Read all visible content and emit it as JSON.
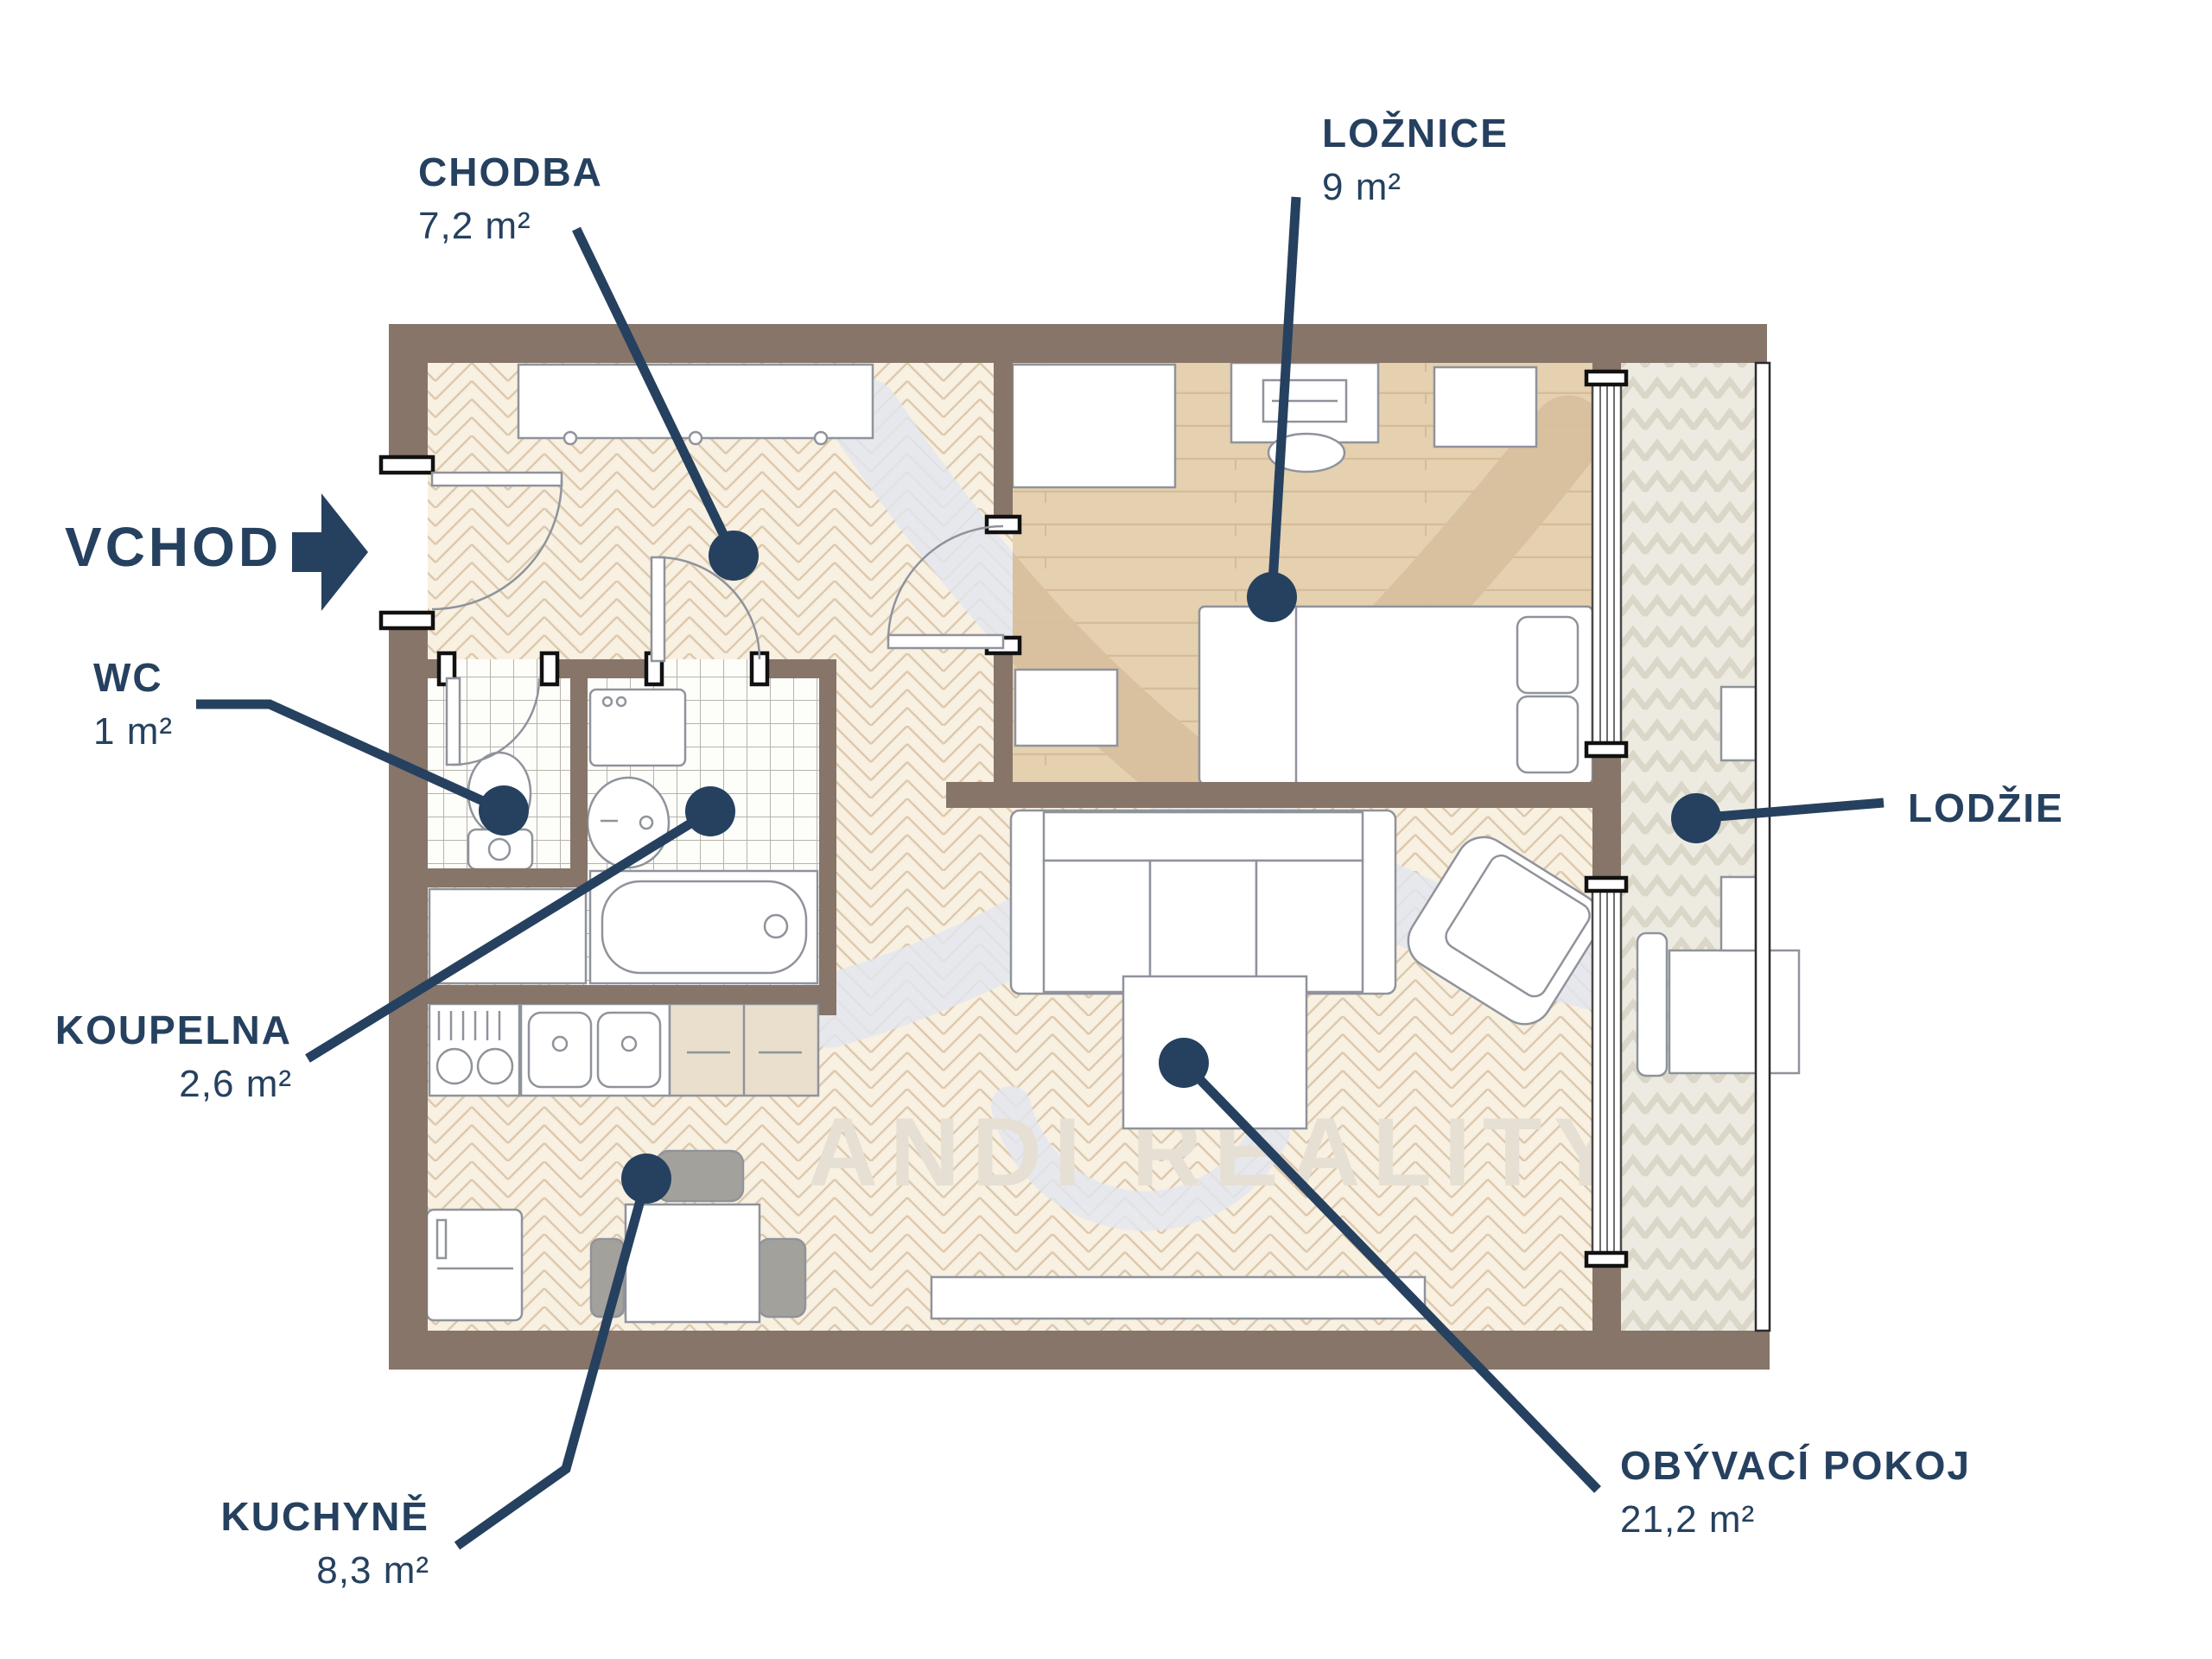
{
  "brand_watermark": "ANDI REALITY",
  "labels": {
    "chodba": {
      "name": "CHODBA",
      "area": "7,2 m²"
    },
    "loznice": {
      "name": "LOŽNICE",
      "area": "9 m²"
    },
    "vchod": {
      "name": "VCHOD"
    },
    "wc": {
      "name": "WC",
      "area": "1 m²"
    },
    "koupelna": {
      "name": "KOUPELNA",
      "area": "2,6 m²"
    },
    "kuchyne": {
      "name": "KUCHYNĚ",
      "area": "8,3 m²"
    },
    "obyvaci_pokoj": {
      "name": "OBÝVACÍ POKOJ",
      "area": "21,2 m²"
    },
    "lodzie": {
      "name": "LODŽIE"
    }
  },
  "colors": {
    "navy": "#26415f",
    "wall": "#87756a",
    "cream": "#f8f0e1",
    "cream_line": "#ddc9ae",
    "wood": "#e5d0af",
    "wood_line": "#d5bc97",
    "tile": "#fdfdfa",
    "tile_line": "#b7b3ab",
    "balcony": "#edebe1",
    "balcony_line": "#d7d3c3",
    "furn_line": "#8f939b",
    "chair": "#a3a19c",
    "counter": "#e9dfcc",
    "wm_text": "#e6dfd3",
    "wm_blue": "#e3e7f0",
    "wm_tan": "#d8bd97"
  }
}
